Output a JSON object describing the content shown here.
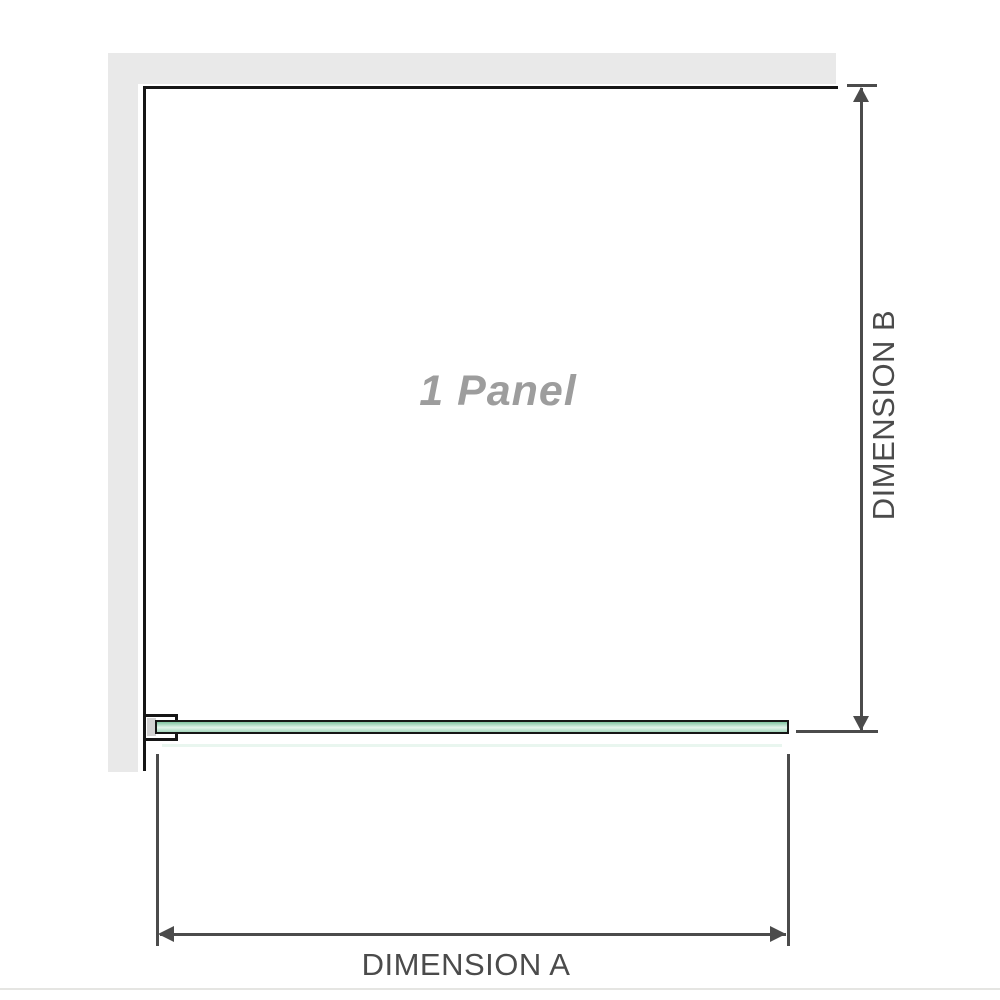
{
  "diagram": {
    "panel_label": "1 Panel",
    "dimensions": {
      "a_label": "DIMENSION A",
      "b_label": "DIMENSION B"
    },
    "colors": {
      "wall": "#e9e9e9",
      "edge": "#161616",
      "dim": "#4b4b4b",
      "panel_label": "#9d9d9d",
      "glass_border": "#161616",
      "glass_top": "#7fc3a0",
      "glass_mid": "#e2f3ea",
      "glass_bottom": "#a4d7bc",
      "bracket_pad": "#d2d2d2",
      "rule": "#e5e5e2"
    }
  }
}
